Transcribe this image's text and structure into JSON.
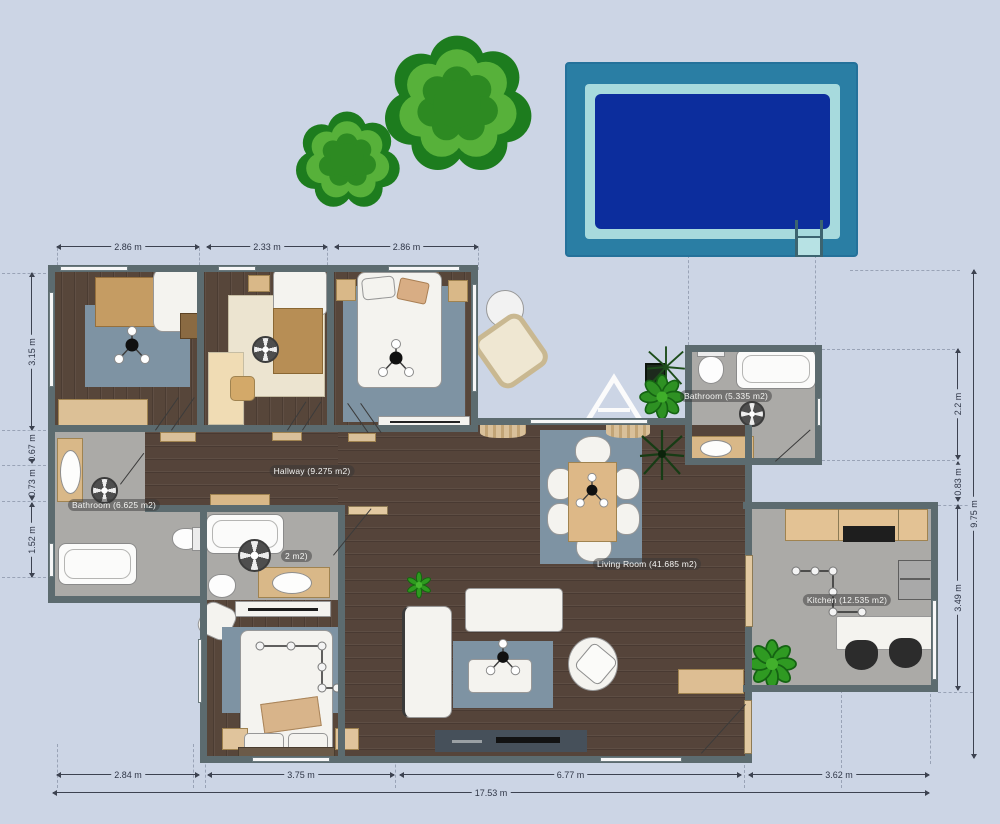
{
  "plan": {
    "labels": [
      {
        "id": "hallway-label",
        "text": "Hallway (9.275 m2)",
        "x": 312,
        "y": 471
      },
      {
        "id": "bathroom-left-label",
        "text": "Bathroom (6.625 m2)",
        "x": 114,
        "y": 505
      },
      {
        "id": "bathroom-top-label",
        "text": "Bathroom (5.335 m2)",
        "x": 726,
        "y": 396
      },
      {
        "id": "living-room-label",
        "text": "Living Room (41.685 m2)",
        "x": 647,
        "y": 564
      },
      {
        "id": "kitchen-label",
        "text": "Kitchen (12.535 m2)",
        "x": 847,
        "y": 600
      },
      {
        "id": "ensuite-label",
        "text": "2 m2)",
        "x": 281,
        "y": 556,
        "align": "left"
      }
    ],
    "dimensions": {
      "top": [
        {
          "text": "2.86 m",
          "x1": 57,
          "x2": 199,
          "y": 246
        },
        {
          "text": "2.33 m",
          "x1": 207,
          "x2": 327,
          "y": 246
        },
        {
          "text": "2.86 m",
          "x1": 335,
          "x2": 478,
          "y": 246
        }
      ],
      "left": [
        {
          "text": "3.15 m",
          "y1": 273,
          "y2": 430,
          "x": 31
        },
        {
          "text": "0.67 m",
          "y1": 432,
          "y2": 463,
          "x": 31
        },
        {
          "text": "0.73 m",
          "y1": 466,
          "y2": 500,
          "x": 31
        },
        {
          "text": "1.52 m",
          "y1": 503,
          "y2": 577,
          "x": 31
        }
      ],
      "right": [
        {
          "text": "2.2 m",
          "y1": 349,
          "y2": 459,
          "x": 957
        },
        {
          "text": "0.83 m",
          "y1": 462,
          "y2": 501,
          "x": 957
        },
        {
          "text": "3.49 m",
          "y1": 505,
          "y2": 690,
          "x": 957
        },
        {
          "text": "9.75 m",
          "y1": 270,
          "y2": 758,
          "x": 973
        }
      ],
      "bottom": [
        {
          "text": "2.84 m",
          "x1": 57,
          "x2": 199,
          "y": 774
        },
        {
          "text": "3.75 m",
          "x1": 208,
          "x2": 394,
          "y": 774
        },
        {
          "text": "6.77 m",
          "x1": 400,
          "x2": 741,
          "y": 774
        },
        {
          "text": "3.62 m",
          "x1": 749,
          "x2": 929,
          "y": 774
        },
        {
          "text": "17.53 m",
          "x1": 53,
          "x2": 929,
          "y": 792
        }
      ]
    },
    "colors": {
      "background": "#ccd5e5",
      "wall": "#5c6b6f",
      "wood": "#57463a",
      "tile": "#abaaa7",
      "rug": "#7e93a3",
      "furniture_tan": "#d9b888",
      "pool_frame": "#2a7ea4",
      "pool_inner": "#a7dadd",
      "pool_water": "#0c2d9d",
      "tree_dark": "#1d7c1e",
      "tree_light": "#57b13a",
      "tree_mid": "#2d8a22"
    }
  }
}
